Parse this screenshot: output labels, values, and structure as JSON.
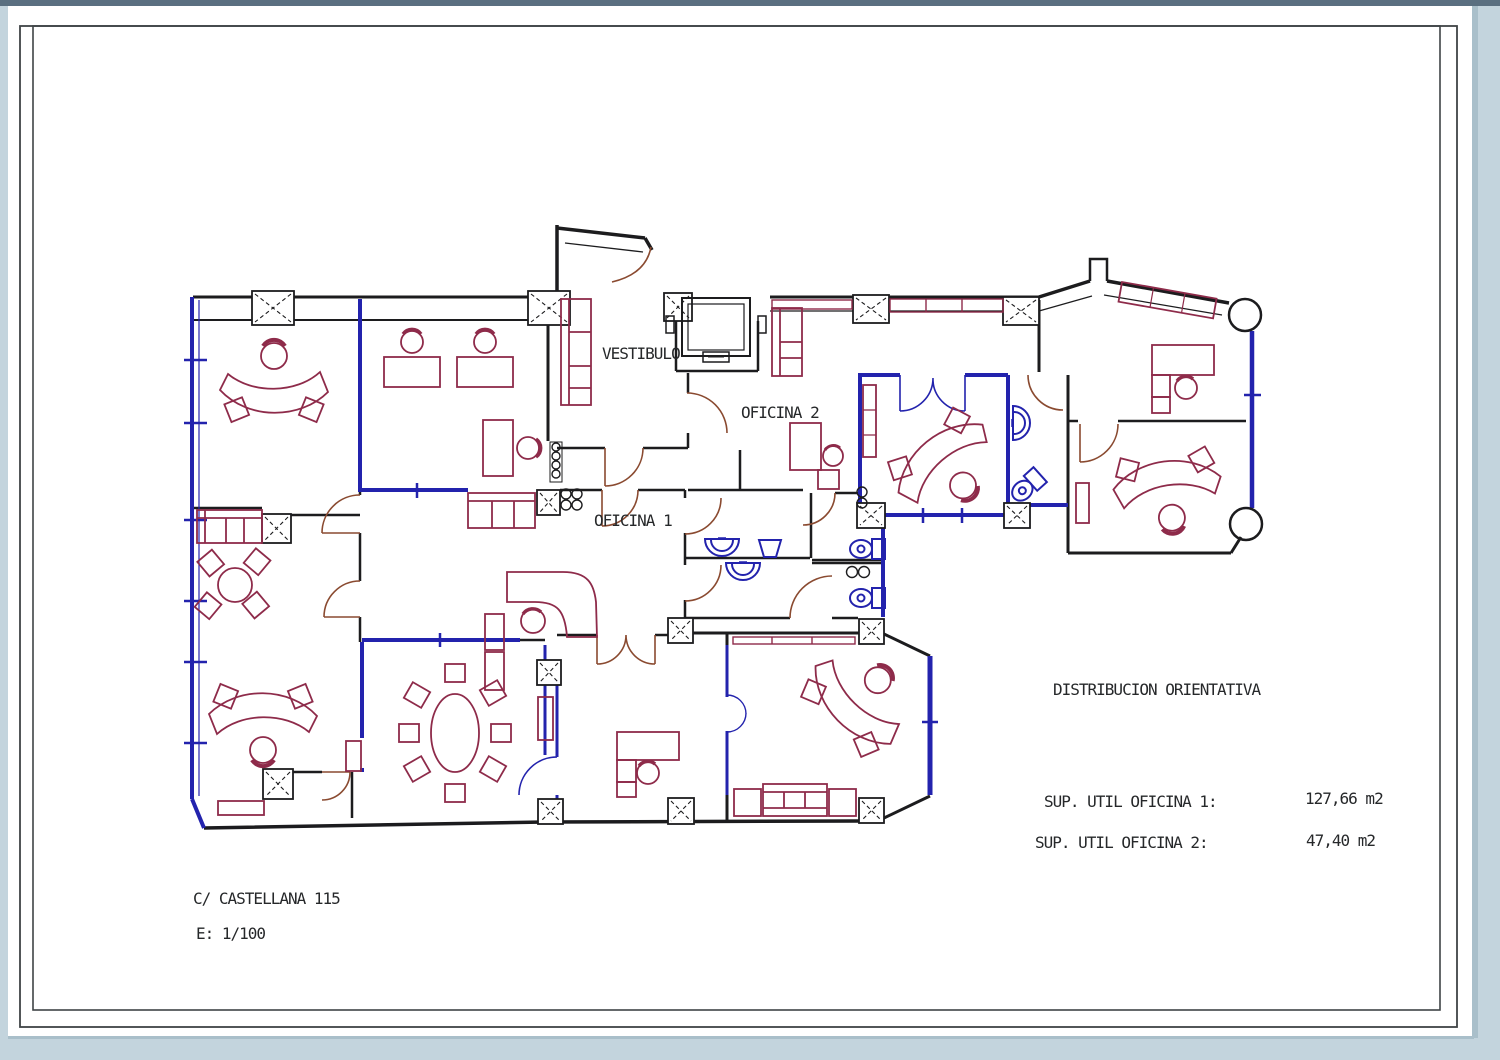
{
  "labels": {
    "vestibulo": "VESTIBULO",
    "oficina2": "OFICINA 2",
    "oficina1": "OFICINA 1",
    "distribucion": "DISTRIBUCION ORIENTATIVA",
    "sup1_label": "SUP. UTIL OFICINA 1:",
    "sup1_value": "127,66 m2",
    "sup2_label": "SUP. UTIL OFICINA 2:",
    "sup2_value": "47,40 m2",
    "address": "C/ CASTELLANA 115",
    "scale": "E: 1/100"
  },
  "colors": {
    "wall": "#1c1c1e",
    "window": "#2323ad",
    "furniture": "#8e2b4a",
    "door": "#8a4a30",
    "paper": "#ffffff",
    "surround": "#c3d4dd",
    "top_band": "#5a6f80",
    "frame": "#3f4446"
  }
}
